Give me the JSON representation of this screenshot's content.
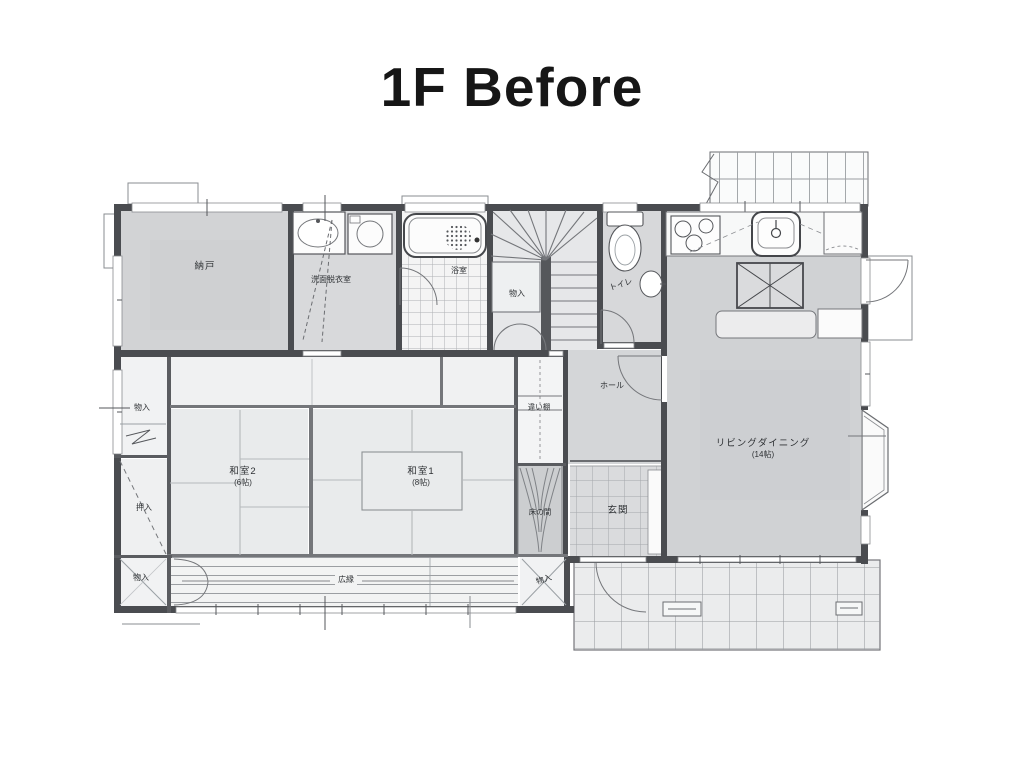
{
  "page": {
    "title": "1F Before"
  },
  "colors": {
    "wall": "#4a4c50",
    "room_gray": "#d2d3d5",
    "room_light": "#e9ebec",
    "paper": "#ffffff",
    "line": "#74767a"
  },
  "plan": {
    "floor": "1F",
    "state_label": "Before",
    "rooms": [
      {
        "id": "nando",
        "label": "納戸"
      },
      {
        "id": "senmen-datsuishitsu",
        "label": "洗面脱衣室"
      },
      {
        "id": "yokushitsu",
        "label": "浴室"
      },
      {
        "id": "monoire-stairs",
        "label": "物入"
      },
      {
        "id": "toilet",
        "label": "トイレ"
      },
      {
        "id": "hall",
        "label": "ホール"
      },
      {
        "id": "chigaidana",
        "label": "違い棚"
      },
      {
        "id": "tokonoma",
        "label": "床の間"
      },
      {
        "id": "genkan",
        "label": "玄関"
      },
      {
        "id": "living-dining",
        "label": "リビングダイニング",
        "size": "(14帖)"
      },
      {
        "id": "washitsu2",
        "label": "和室2",
        "size": "(6帖)"
      },
      {
        "id": "washitsu1",
        "label": "和室1",
        "size": "(8帖)"
      },
      {
        "id": "monoire-left-top",
        "label": "物入"
      },
      {
        "id": "oshiire",
        "label": "押入"
      },
      {
        "id": "monoire-left-bottom",
        "label": "物入"
      },
      {
        "id": "hiroen",
        "label": "広縁"
      },
      {
        "id": "monoire-hiroen",
        "label": "物入"
      }
    ]
  }
}
